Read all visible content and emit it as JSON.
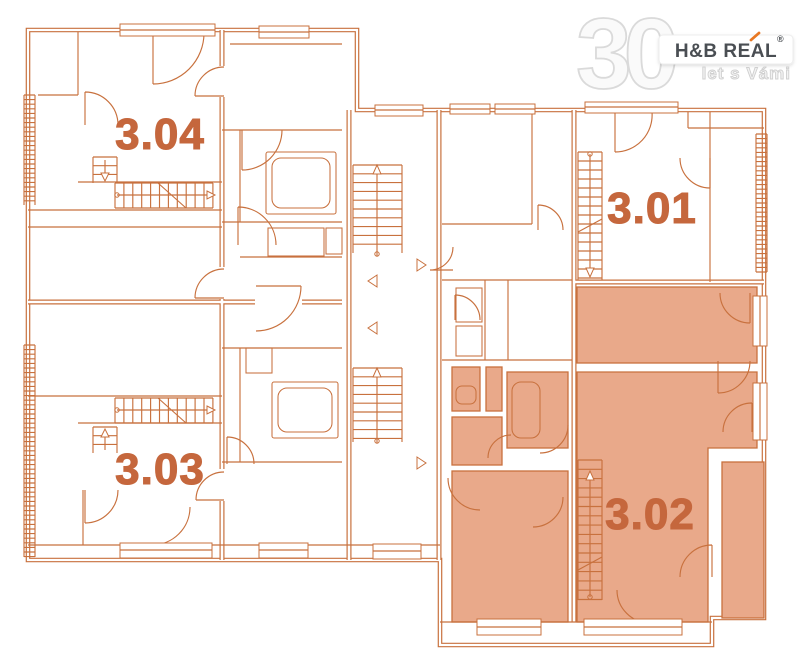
{
  "meta": {
    "type": "floor-plan",
    "highlighted_unit": "3.02"
  },
  "colors": {
    "line": "#c8713e",
    "highlight": "#e9a98a",
    "label": "#c5673d",
    "background": "#ffffff",
    "logo_number": "#fafafa",
    "logo_number_outline": "#dadada",
    "logo_text": "#4a4e53",
    "logo_accent": "#e87722",
    "logo_tagline": "#cfcfcf",
    "logo_box": "#ffffff",
    "logo_box_border": "#ededed"
  },
  "logo": {
    "number": "30",
    "brand": "H&B REAL",
    "registered": "®",
    "tagline": "let s Vámi"
  },
  "units": [
    {
      "id": "3.04",
      "label_x": 160,
      "label_y": 149,
      "highlighted": false
    },
    {
      "id": "3.01",
      "label_x": 652,
      "label_y": 223,
      "highlighted": false
    },
    {
      "id": "3.03",
      "label_x": 160,
      "label_y": 484,
      "highlighted": false
    },
    {
      "id": "3.02",
      "label_x": 650,
      "label_y": 529,
      "highlighted": true
    }
  ]
}
